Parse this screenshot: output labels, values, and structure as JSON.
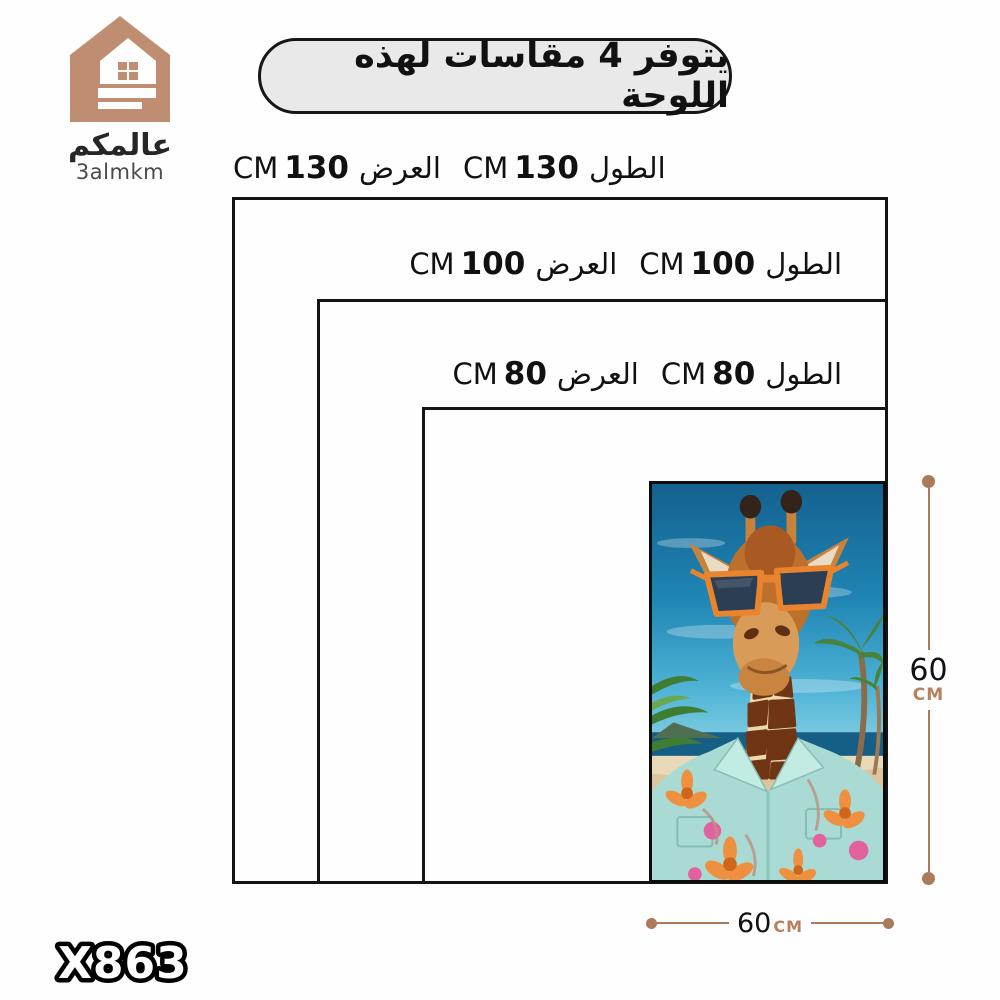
{
  "brand": {
    "name_ar": "عالمكم",
    "name_en": "3almkm"
  },
  "banner": {
    "text": "يتوفر 4 مقاسات لهذه اللوحة"
  },
  "size_rows": [
    {
      "length_label": "الطول",
      "length_value": "130",
      "length_unit": "CM",
      "width_label": "العرض",
      "width_value": "130",
      "width_unit": "CM"
    },
    {
      "length_label": "الطول",
      "length_value": "100",
      "length_unit": "CM",
      "width_label": "العرض",
      "width_value": "100",
      "width_unit": "CM"
    },
    {
      "length_label": "الطول",
      "length_value": "80",
      "length_unit": "CM",
      "width_label": "العرض",
      "width_value": "80",
      "width_unit": "CM"
    }
  ],
  "dimension_indicators": {
    "vertical": {
      "value": "60",
      "unit": "CM"
    },
    "horizontal": {
      "value": "60",
      "unit": "CM"
    }
  },
  "product_code": "X863",
  "artwork": {
    "name": "giraffe-sunglasses-beach-canvas"
  },
  "colors": {
    "accent_tan": "#bf8e72",
    "dimension_line": "#a97a5c",
    "banner_bg": "#e9e9e9",
    "border_black": "#141414"
  }
}
